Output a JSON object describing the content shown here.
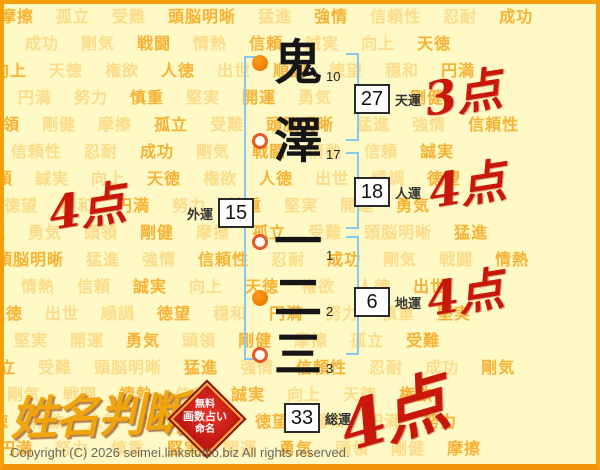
{
  "background": {
    "words": [
      "摩擦",
      "孤立",
      "受難",
      "頭脳明晰",
      "猛進",
      "強情",
      "信頼性",
      "忍耐",
      "成功",
      "剛気",
      "戦闘",
      "情熱",
      "信頼",
      "誠実",
      "向上",
      "天徳",
      "権欲",
      "人徳",
      "出世",
      "順調",
      "徳望",
      "穏和",
      "円満",
      "努力",
      "慎重",
      "堅実",
      "開運",
      "勇気",
      "頭領",
      "剛健"
    ]
  },
  "name": {
    "characters": [
      {
        "char": "鬼",
        "strokes": "10",
        "marker": "filled"
      },
      {
        "char": "澤",
        "strokes": "17",
        "marker": "hollow"
      },
      {
        "char": "一",
        "strokes": "1",
        "marker": "hollow"
      },
      {
        "char": "二",
        "strokes": "2",
        "marker": "filled"
      },
      {
        "char": "三",
        "strokes": "3",
        "marker": "hollow"
      }
    ]
  },
  "fortunes": {
    "tenun": {
      "label": "天運",
      "value": "27",
      "score": "3点"
    },
    "jinun": {
      "label": "人運",
      "value": "18",
      "score": "4点"
    },
    "chiun": {
      "label": "地運",
      "value": "6",
      "score": "4点"
    },
    "gaiun": {
      "label": "外運",
      "value": "15",
      "score": "4点"
    },
    "souun": {
      "label": "総運",
      "value": "33",
      "score": "4点"
    }
  },
  "logo": {
    "title": "姓名判断",
    "seal_lines": [
      "無料",
      "画数占い",
      "命名"
    ]
  },
  "footer": {
    "copyright": "Copyright (C) 2026 seimei.linkstudio.biz All rights reserved."
  },
  "colors": {
    "background": "#FFF9C6",
    "frame": "#F5A009",
    "word_orange": "#F59E0A",
    "bracket_blue": "#85C9F0",
    "score_red": "#C9170A",
    "marker_filled": "#EE7E00",
    "marker_hollow_ring": "#E8562A",
    "seal_red": "#C01712"
  }
}
